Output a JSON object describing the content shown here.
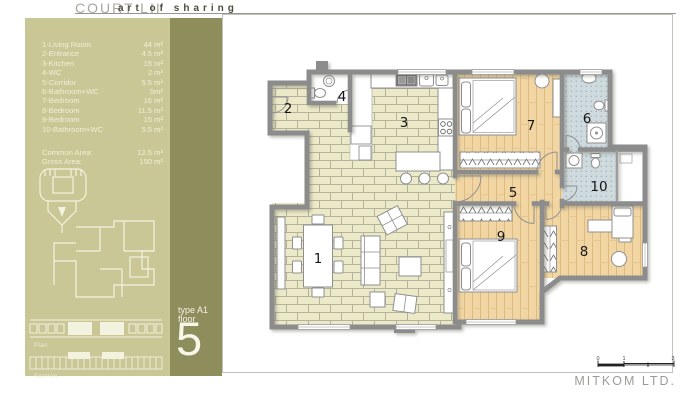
{
  "header": {
    "brand": "COURT LII",
    "tagline": "art of sharing"
  },
  "legend": {
    "rows": [
      {
        "name": "1-Living Room",
        "area": "44 m²"
      },
      {
        "name": "2-Entrance",
        "area": "4.5 m²"
      },
      {
        "name": "3-Kitchen",
        "area": "15 m²"
      },
      {
        "name": "4-WC",
        "area": "2 m²"
      },
      {
        "name": "5-Corridor",
        "area": "5.5 m²"
      },
      {
        "name": "6-Bathroom+WC",
        "area": "5m²"
      },
      {
        "name": "7-Bedroom",
        "area": "16 m²"
      },
      {
        "name": "8-Bedroom",
        "area": "11.5 m²"
      },
      {
        "name": "9-Bedroom",
        "area": "15 m²"
      },
      {
        "name": "10-Bathroom+WC",
        "area": "5.5 m²"
      }
    ],
    "summary": [
      {
        "name": "Common Area:",
        "area": "12.5 m²"
      },
      {
        "name": "Gross Area:",
        "area": "150 m²"
      }
    ]
  },
  "sidebar": {
    "plan_thumb_label": "Plan",
    "section_thumb_label": "Section",
    "type_label": "type A1",
    "floor_label": "floor",
    "floor_number": "5"
  },
  "plan": {
    "rooms": [
      {
        "number": "1"
      },
      {
        "number": "2"
      },
      {
        "number": "3"
      },
      {
        "number": "4"
      },
      {
        "number": "5"
      },
      {
        "number": "6"
      },
      {
        "number": "7"
      },
      {
        "number": "8"
      },
      {
        "number": "9"
      },
      {
        "number": "10"
      }
    ]
  },
  "scale_bar": {
    "labels": [
      "0",
      "1",
      "3"
    ]
  },
  "footer": {
    "company": "MITKOM LTD."
  },
  "colors": {
    "sidebar_light": "#c8c795",
    "sidebar_dark": "#8e8d5c",
    "wall": "#8c8c8c",
    "brick_floor": "#ebe9c8",
    "wood_floor": "#f1d6a4",
    "bath_tile": "#cfdade"
  }
}
